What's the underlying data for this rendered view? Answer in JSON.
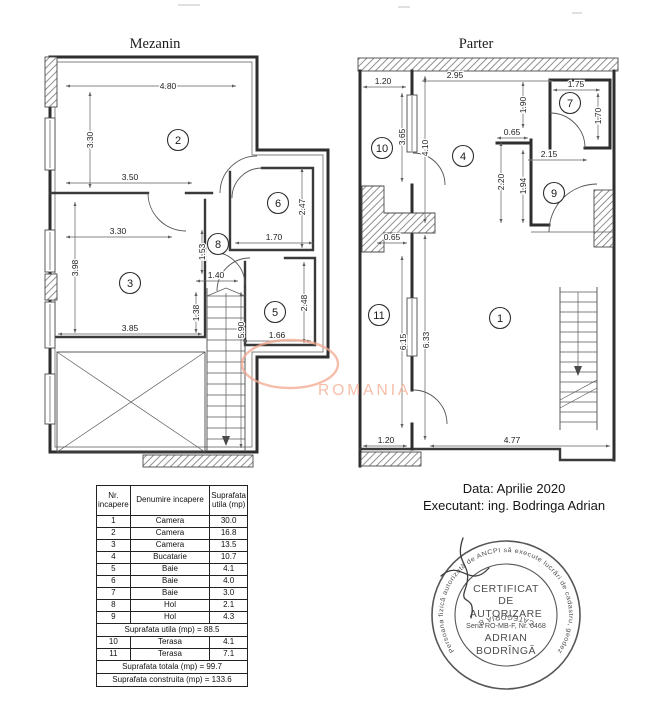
{
  "watermark": {
    "text": "ROMANIA",
    "color": "#f5b29a"
  },
  "plans": {
    "mezanin": {
      "title": "Mezanin",
      "rooms": [
        {
          "n": "2",
          "x": 178,
          "y": 140
        },
        {
          "n": "3",
          "x": 130,
          "y": 283
        },
        {
          "n": "5",
          "x": 275,
          "y": 312
        },
        {
          "n": "6",
          "x": 278,
          "y": 203
        },
        {
          "n": "8",
          "x": 218,
          "y": 244
        }
      ],
      "dims": [
        {
          "v": "4.80",
          "x": 168,
          "y": 89,
          "r": 0
        },
        {
          "v": "3.30",
          "x": 93,
          "y": 140,
          "r": -90
        },
        {
          "v": "3.50",
          "x": 130,
          "y": 180,
          "r": 0
        },
        {
          "v": "3.30",
          "x": 118,
          "y": 234,
          "r": 0
        },
        {
          "v": "3.98",
          "x": 78,
          "y": 268,
          "r": -90
        },
        {
          "v": "1.53",
          "x": 205,
          "y": 252,
          "r": -90
        },
        {
          "v": "1.40",
          "x": 216,
          "y": 278,
          "r": 0
        },
        {
          "v": "1.38",
          "x": 199,
          "y": 313,
          "r": -90
        },
        {
          "v": "3.85",
          "x": 130,
          "y": 331,
          "r": 0
        },
        {
          "v": "2.47",
          "x": 305,
          "y": 207,
          "r": -90
        },
        {
          "v": "1.70",
          "x": 274,
          "y": 240,
          "r": 0
        },
        {
          "v": "2.48",
          "x": 307,
          "y": 303,
          "r": -90
        },
        {
          "v": "1.66",
          "x": 277,
          "y": 338,
          "r": 0
        },
        {
          "v": "5.90",
          "x": 244,
          "y": 330,
          "r": -90
        }
      ]
    },
    "parter": {
      "title": "Parter",
      "rooms": [
        {
          "n": "1",
          "x": 500,
          "y": 318
        },
        {
          "n": "4",
          "x": 463,
          "y": 156
        },
        {
          "n": "7",
          "x": 570,
          "y": 103
        },
        {
          "n": "9",
          "x": 554,
          "y": 193
        },
        {
          "n": "10",
          "x": 382,
          "y": 148
        },
        {
          "n": "11",
          "x": 379,
          "y": 315
        }
      ],
      "dims": [
        {
          "v": "1.20",
          "x": 383,
          "y": 84,
          "r": 0
        },
        {
          "v": "2.95",
          "x": 455,
          "y": 78,
          "r": 0
        },
        {
          "v": "1.75",
          "x": 576,
          "y": 87,
          "r": 0
        },
        {
          "v": "1.90",
          "x": 526,
          "y": 105,
          "r": -90
        },
        {
          "v": "1.70",
          "x": 601,
          "y": 116,
          "r": -90
        },
        {
          "v": "3.65",
          "x": 405,
          "y": 137,
          "r": -90
        },
        {
          "v": "4.10",
          "x": 428,
          "y": 148,
          "r": -90
        },
        {
          "v": "0.65",
          "x": 512,
          "y": 135,
          "r": 0
        },
        {
          "v": "2.15",
          "x": 549,
          "y": 157,
          "r": 0
        },
        {
          "v": "2.20",
          "x": 504,
          "y": 182,
          "r": -90
        },
        {
          "v": "1.94",
          "x": 526,
          "y": 186,
          "r": -90
        },
        {
          "v": "0.65",
          "x": 392,
          "y": 240,
          "r": 0
        },
        {
          "v": "6.15",
          "x": 406,
          "y": 342,
          "r": -90
        },
        {
          "v": "6.33",
          "x": 429,
          "y": 340,
          "r": -90
        },
        {
          "v": "1.20",
          "x": 386,
          "y": 443,
          "r": 0
        },
        {
          "v": "4.77",
          "x": 512,
          "y": 443,
          "r": 0
        }
      ]
    }
  },
  "table": {
    "headers": [
      "Nr. incapere",
      "Denumire incapere",
      "Suprafata utila (mp)"
    ],
    "rows": [
      [
        "1",
        "Camera",
        "30.0"
      ],
      [
        "2",
        "Camera",
        "16.8"
      ],
      [
        "3",
        "Camera",
        "13.5"
      ],
      [
        "4",
        "Bucatarie",
        "10.7"
      ],
      [
        "5",
        "Baie",
        "4.1"
      ],
      [
        "6",
        "Baie",
        "4.0"
      ],
      [
        "7",
        "Baie",
        "3.0"
      ],
      [
        "8",
        "Hol",
        "2.1"
      ],
      [
        "9",
        "Hol",
        "4.3"
      ]
    ],
    "subtotal": "Suprafata utila (mp) = 88.5",
    "terrace_rows": [
      [
        "10",
        "Terasa",
        "4.1"
      ],
      [
        "11",
        "Terasa",
        "7.1"
      ]
    ],
    "total": "Suprafata totala (mp) = 99.7",
    "built": "Suprafata construita (mp) = 133.6"
  },
  "footer": {
    "date": "Data: Aprilie 2020",
    "executant": "Executant: ing. Bodringa  Adrian"
  },
  "stamp": {
    "ring_text": "Persoana fizică autorizată de ANCPI să execute lucrări de cadastru, geodezie şi cartografie",
    "category": "CATEGORIA B",
    "line1": "CERTIFICAT",
    "line2": "DE",
    "line3": "AUTORIZARE",
    "line4": "Seria RO-MB-F, Nr. 0468",
    "line5": "ADRIAN",
    "line6": "BODRÎNGĂ"
  }
}
